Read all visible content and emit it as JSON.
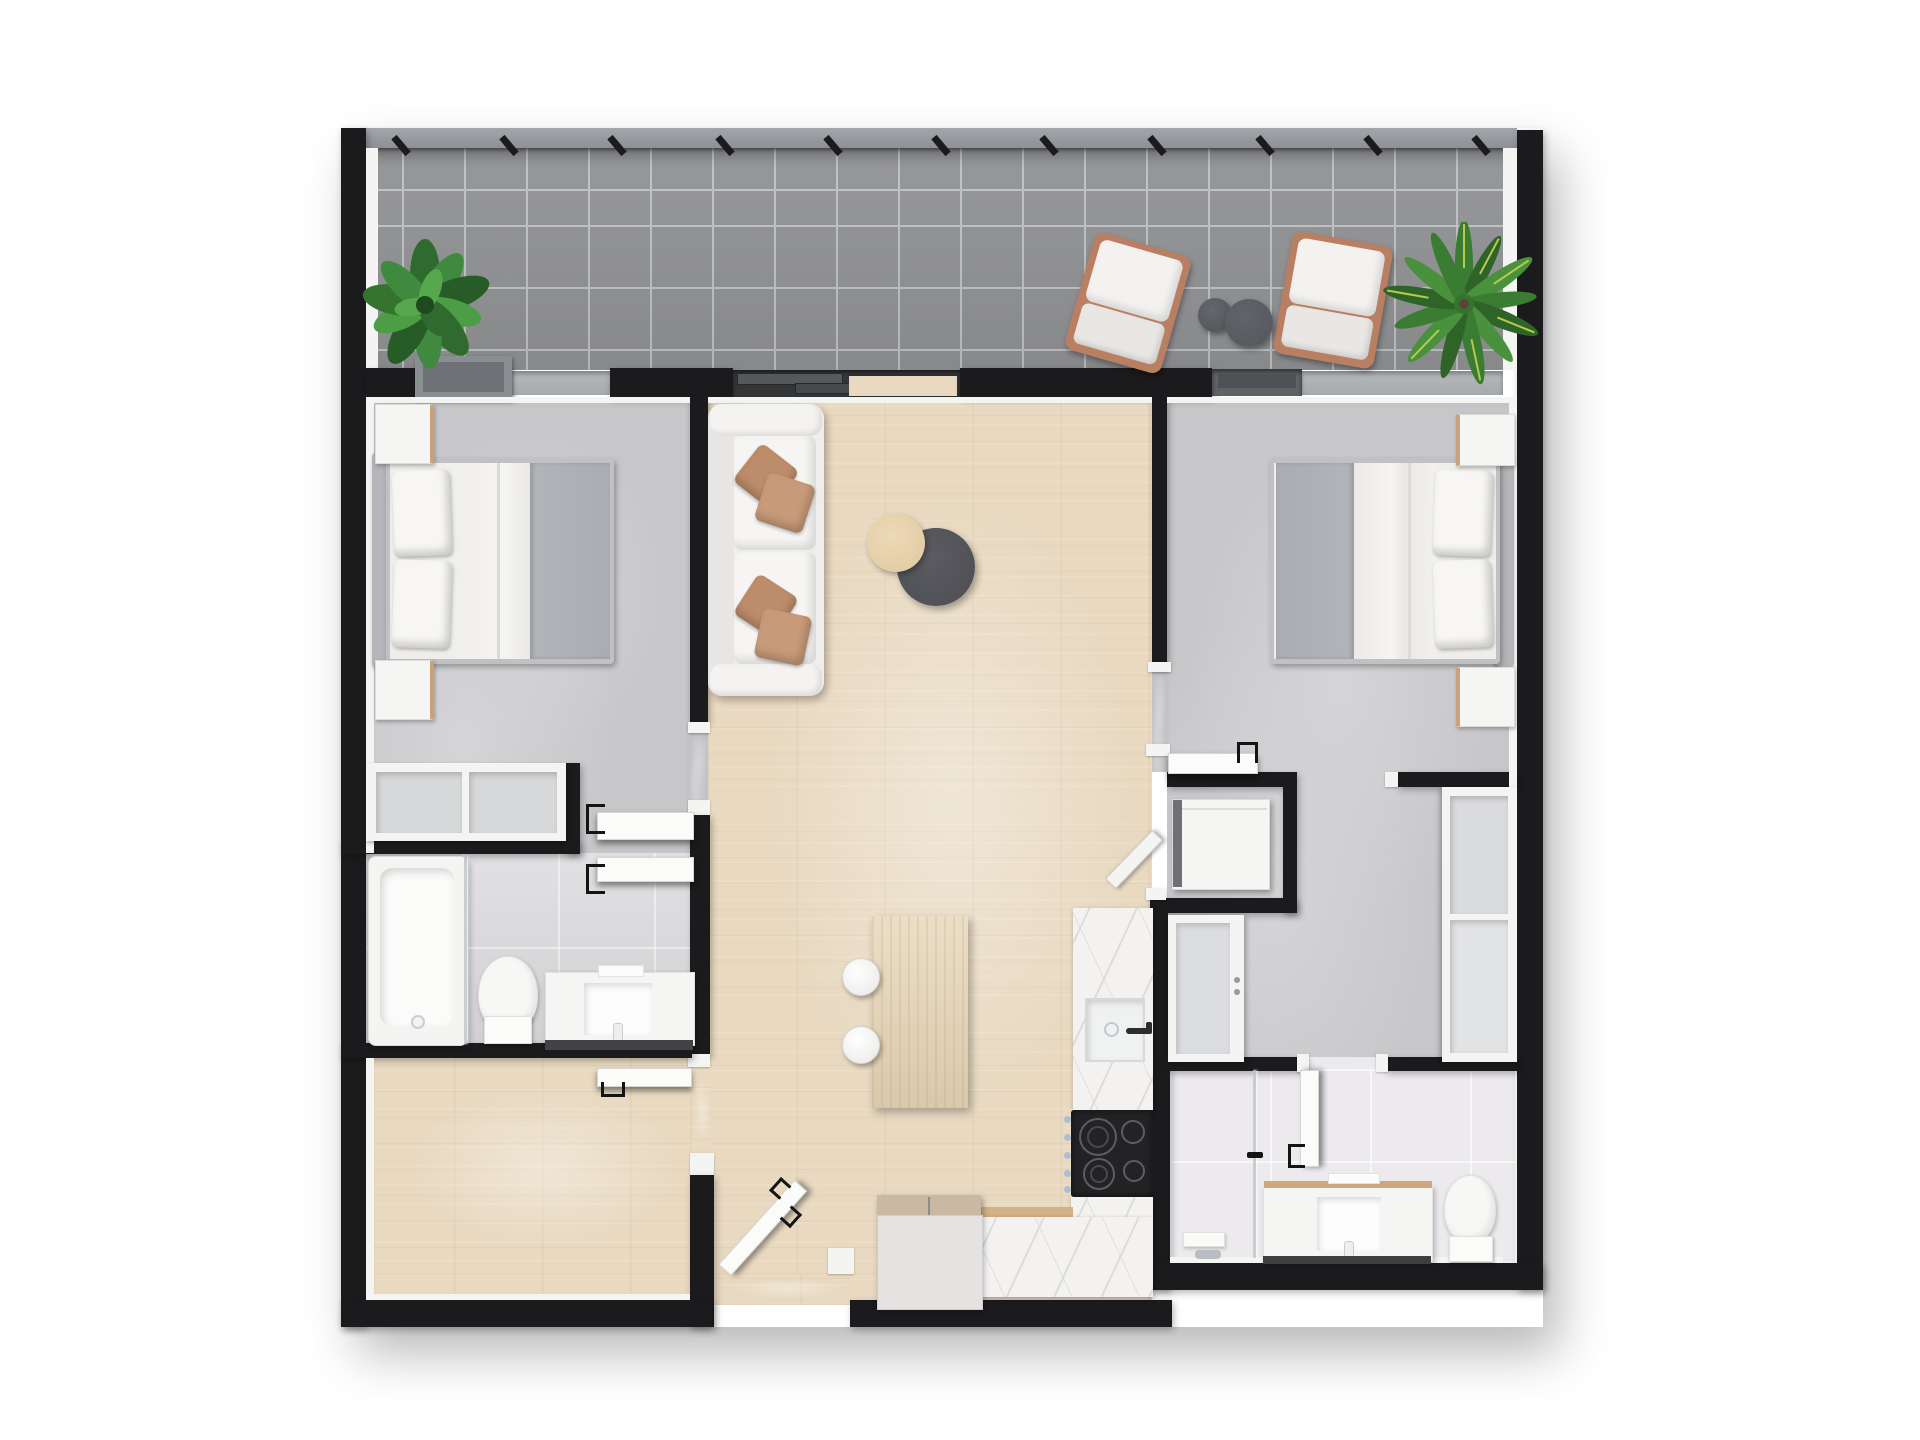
{
  "artwork": {
    "kind": "top-down 3D rendered apartment floor plan",
    "background": "#ffffff"
  },
  "palette": {
    "wall": "#1b1b1d",
    "trim": "#f4f4f3",
    "balconyTile": "#929395",
    "balconyGrout": "#c0c3c5",
    "railing": "#a3a7ab",
    "concrete": "#c7c6c9",
    "concreteLight": "#d5d4d7",
    "wood": "#e8d9c0",
    "bathTile": "#d8d6d9",
    "bath2Tile": "#eceaed",
    "marble": "#f3f2f1",
    "marbleVein": "#dcdcda",
    "islandWood": "#e5d4b4",
    "counterWoodEdge": "#d2b286",
    "cooktop": "#232326",
    "burnerRing": "#5d5d61",
    "knobSteel": "#aebdd2",
    "white": "#f5f5f4",
    "softWhite": "#efeeec",
    "seatShade": "#e9e7e4",
    "blanketGray": "#a9adb2",
    "pillowTan": "#bd8c6a",
    "pillowTanLight": "#c79a79",
    "chairWood": "#b97f63",
    "tableDark": "#515257",
    "tableLight": "#e3cda6",
    "plantDark": "#275c27",
    "plantMid": "#35742f",
    "plantLight": "#4d9c46",
    "palmVein": "#b9c84e",
    "planter": "#8a8e92",
    "planterInner": "#6e7276",
    "applianceBody": "#e4e3e2",
    "applianceTop": "#c9b8a2",
    "steelDark": "#6f7075",
    "shadowStrip": "#434345",
    "sill": "#b7babd",
    "doorChannel": "#5f6367",
    "sliderBase": "#333537",
    "sliderPanel": "#56595c"
  },
  "rooms": [
    {
      "name": "balcony",
      "floor": "gray tile"
    },
    {
      "name": "bedroom-1",
      "floor": "concrete"
    },
    {
      "name": "living-room",
      "floor": "light oak"
    },
    {
      "name": "bedroom-2",
      "floor": "concrete"
    },
    {
      "name": "bathroom-1",
      "floor": "light tile"
    },
    {
      "name": "den",
      "floor": "light oak"
    },
    {
      "name": "kitchen-dining",
      "floor": "light oak"
    },
    {
      "name": "laundry-nook",
      "floor": "concrete"
    },
    {
      "name": "bathroom-2",
      "floor": "white tile"
    },
    {
      "name": "entry",
      "floor": "light oak"
    }
  ],
  "furniture": [
    {
      "name": "potted-plant",
      "count": 2
    },
    {
      "name": "outdoor-lounge-chair",
      "count": 2
    },
    {
      "name": "outdoor-side-table",
      "count": 2
    },
    {
      "name": "balcony-planter-box",
      "count": 1
    },
    {
      "name": "double-bed",
      "count": 2
    },
    {
      "name": "nightstand",
      "count": 4
    },
    {
      "name": "open-shelf-closet",
      "count": 3
    },
    {
      "name": "sofa",
      "count": 1
    },
    {
      "name": "throw-pillow",
      "count": 4
    },
    {
      "name": "coffee-table-round",
      "count": 2
    },
    {
      "name": "kitchen-island",
      "count": 1
    },
    {
      "name": "stool",
      "count": 2
    },
    {
      "name": "kitchen-sink",
      "count": 1
    },
    {
      "name": "cooktop",
      "count": 1
    },
    {
      "name": "refrigerator-cabinet",
      "count": 1
    },
    {
      "name": "pantry-cabinet",
      "count": 1
    },
    {
      "name": "washer",
      "count": 1
    },
    {
      "name": "bathtub",
      "count": 1
    },
    {
      "name": "shower",
      "count": 1
    },
    {
      "name": "toilet",
      "count": 2
    },
    {
      "name": "vanity-sink",
      "count": 2
    },
    {
      "name": "interior-door",
      "count": 6
    }
  ]
}
